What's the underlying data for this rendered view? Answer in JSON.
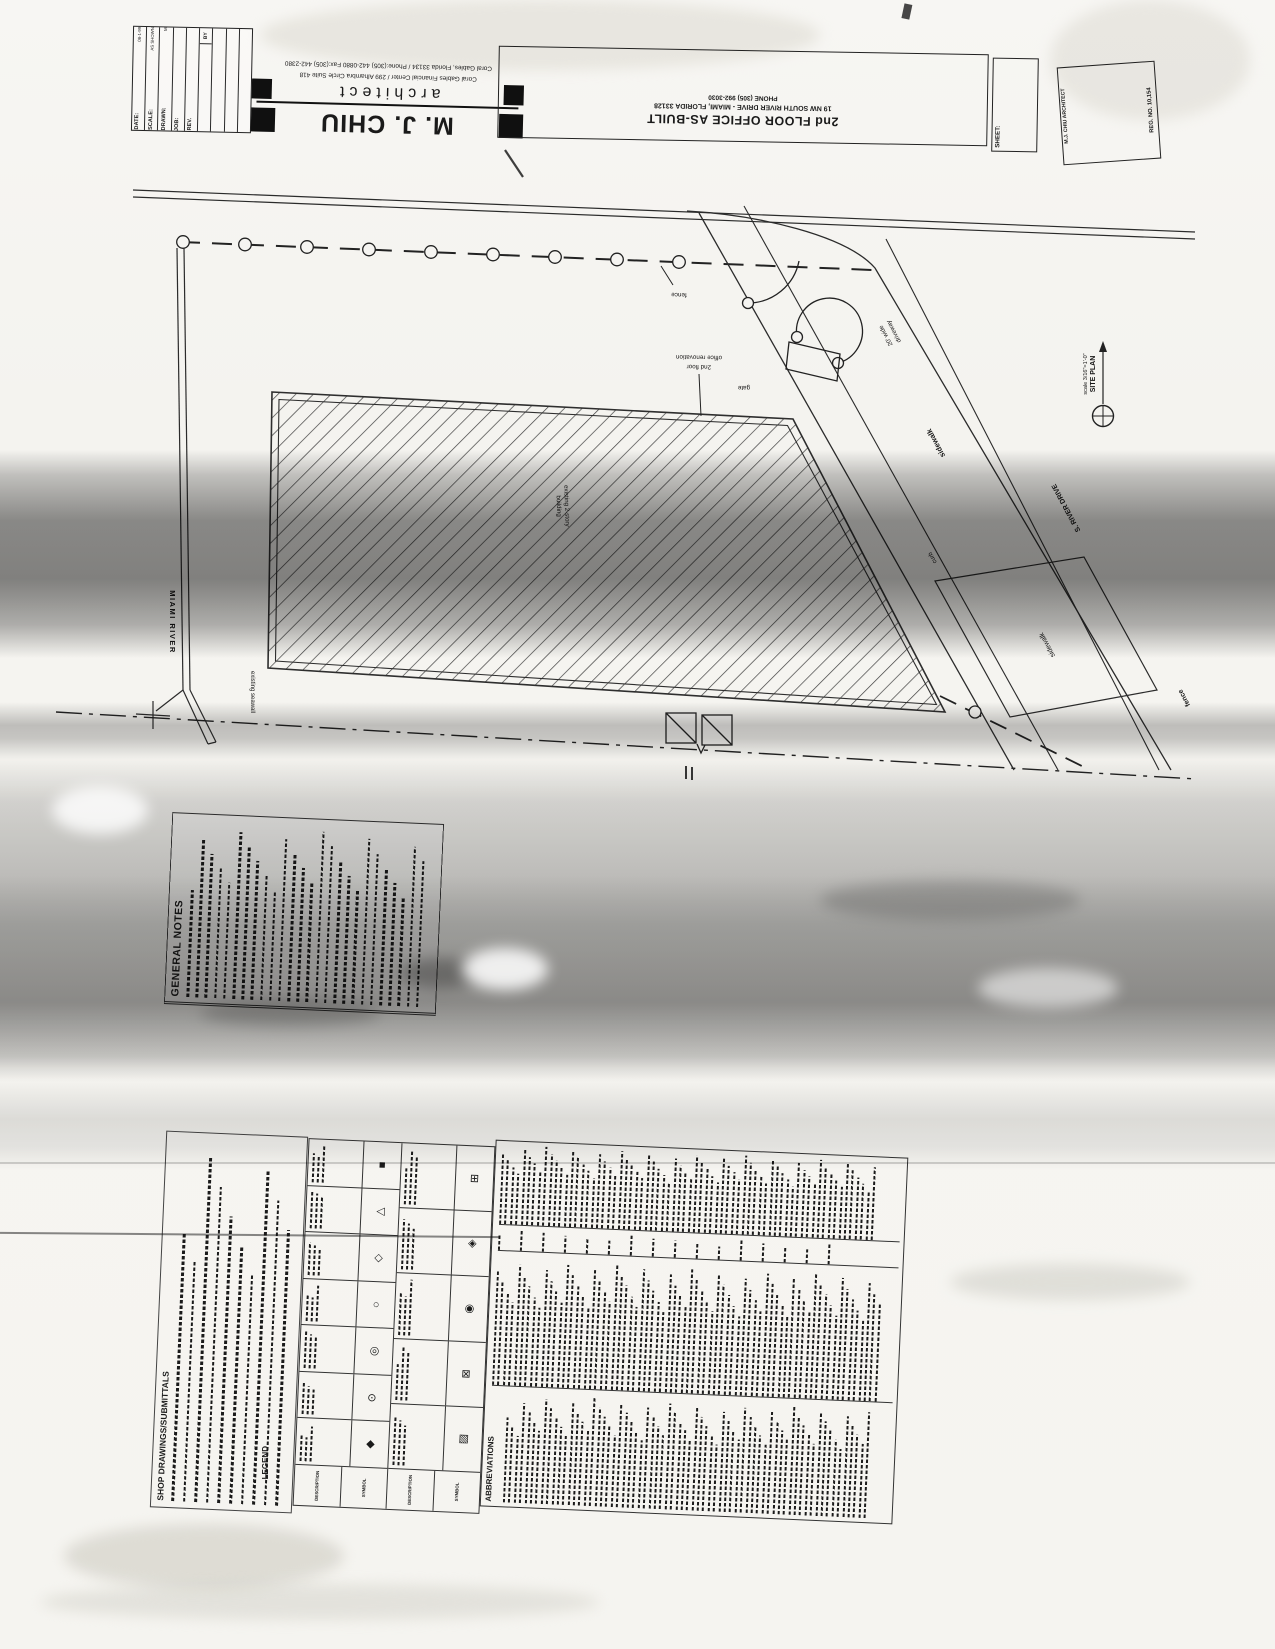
{
  "revision_table": {
    "by": "BY",
    "rows": [
      {
        "label": "DATE:",
        "value": "08-1-99"
      },
      {
        "label": "SCALE:",
        "value": "AS SHOWN"
      },
      {
        "label": "DRAWN:",
        "value": "M"
      },
      {
        "label": "JOB:",
        "value": ""
      },
      {
        "label": "REV.",
        "value": ""
      }
    ]
  },
  "firm": {
    "name": "M. J. CHIU",
    "role": "architect",
    "address1": "Coral Gables Financial Center / 299 Alhambra Circle Suite 418",
    "address2": "Coral Gables, Florida 33134 / Phone:(305) 442-0880 Fax:(305) 442-2380"
  },
  "project": {
    "title": "2nd FLOOR OFFICE AS-BUILT",
    "address": "19 NW SOUTH RIVER DRIVE - MIAMI, FLORIDA 33128",
    "phone": "PHONE (305) 992-3030"
  },
  "sheet": {
    "label": "SHEET:"
  },
  "seal": {
    "architect": "M.J. CHIU ARCHITECT",
    "registration": "REG. NO. 10,154"
  },
  "site_plan": {
    "title": "SITE PLAN",
    "scale": "scale 3/16\"=1'-0\"",
    "labels": {
      "miami_river": "MIAMI RIVER",
      "seawall": "existing seawall",
      "fence_top": "fence",
      "fence_bottom": "fence",
      "gate": "gate",
      "renovation_l1": "2nd floor",
      "renovation_l2": "office renovation",
      "driveway_l1": "20' wide",
      "driveway_l2": "driveway",
      "sidewalk_upper": "sidewalk",
      "curb": "curb",
      "sidewalk_lower": "sidewalk",
      "street": "S. RIVER DRIVE",
      "building_l1": "existing 2-story",
      "building_l2": "building"
    }
  },
  "general_notes": {
    "title": "GENERAL NOTES"
  },
  "shop_drawings": {
    "title": "SHOP DRAWINGS/SUBMITTALS"
  },
  "legend": {
    "title": "LEGEND",
    "symbol_header": "SYMBOL",
    "description_header": "DESCRIPTION",
    "symbols": [
      {
        "name": "diamond-solid-marker",
        "glyph": "◆"
      },
      {
        "name": "circle-dot-marker",
        "glyph": "⊙"
      },
      {
        "name": "circle-double-marker",
        "glyph": "◎"
      },
      {
        "name": "circle-outline-marker",
        "glyph": "○"
      },
      {
        "name": "diamond-outline-marker",
        "glyph": "◇"
      },
      {
        "name": "triangle-marker",
        "glyph": "△"
      },
      {
        "name": "square-solid-marker",
        "glyph": "■"
      },
      {
        "name": "square-hatched-marker",
        "glyph": "▨"
      },
      {
        "name": "square-x-marker",
        "glyph": "⊠"
      },
      {
        "name": "circle-target-marker",
        "glyph": "◉"
      },
      {
        "name": "diamond-inset-marker",
        "glyph": "◈"
      },
      {
        "name": "square-grid-marker",
        "glyph": "⊞"
      }
    ]
  },
  "abbreviations": {
    "title": "ABBREVIATIONS"
  }
}
